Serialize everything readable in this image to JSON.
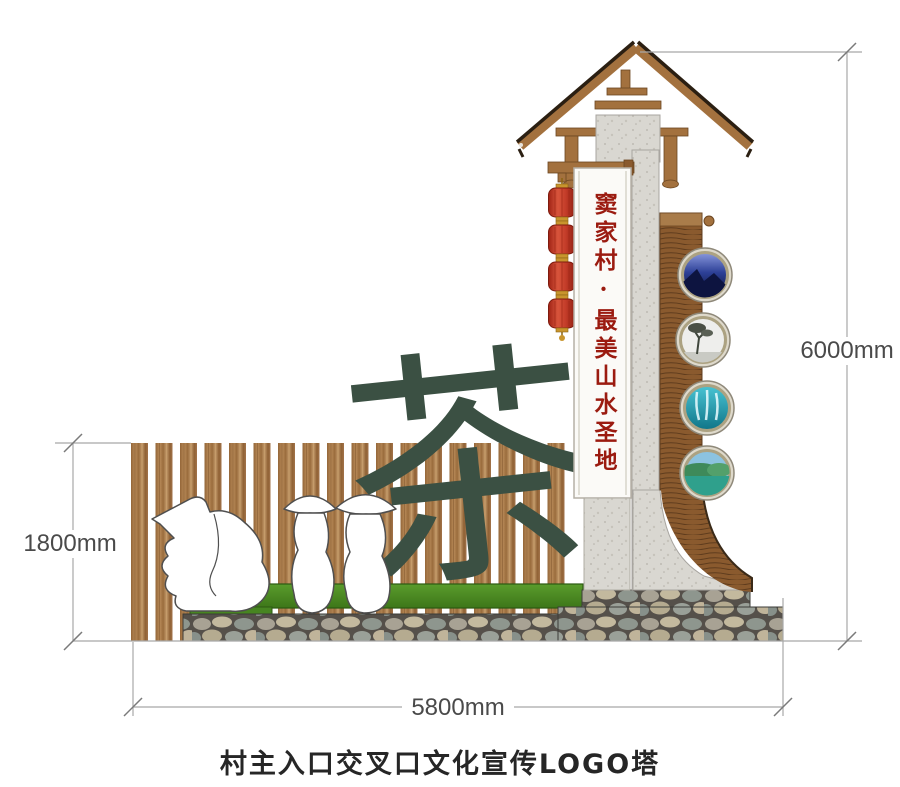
{
  "caption": {
    "text": "村主入口交叉口文化宣传LOGO塔"
  },
  "tower": {
    "banner_text": "窦家村·最美山水圣地",
    "lantern_count": 4,
    "photo_frames": [
      "blue-mountains-photo",
      "misty-tree-photo",
      "waterfall-photo",
      "lake-hills-photo"
    ]
  },
  "artwork": {
    "calligraphy_character": "茶"
  },
  "dimensions": {
    "fence_height": "1800mm",
    "tower_height": "6000mm",
    "base_width": "5800mm"
  },
  "colors": {
    "calligraphy_green": "#3B5043",
    "banner_red": "#9B1B10",
    "lantern_red": "#C23B2A",
    "grass_green": "#4C8B24",
    "fence_wood_brown": "#A4744A",
    "rattan_brown": "#8A5A2E",
    "concrete_gray": "#D9D7D1",
    "stone_gray": "#9AA098",
    "dimension_line_gray": "#A8A8A8"
  }
}
